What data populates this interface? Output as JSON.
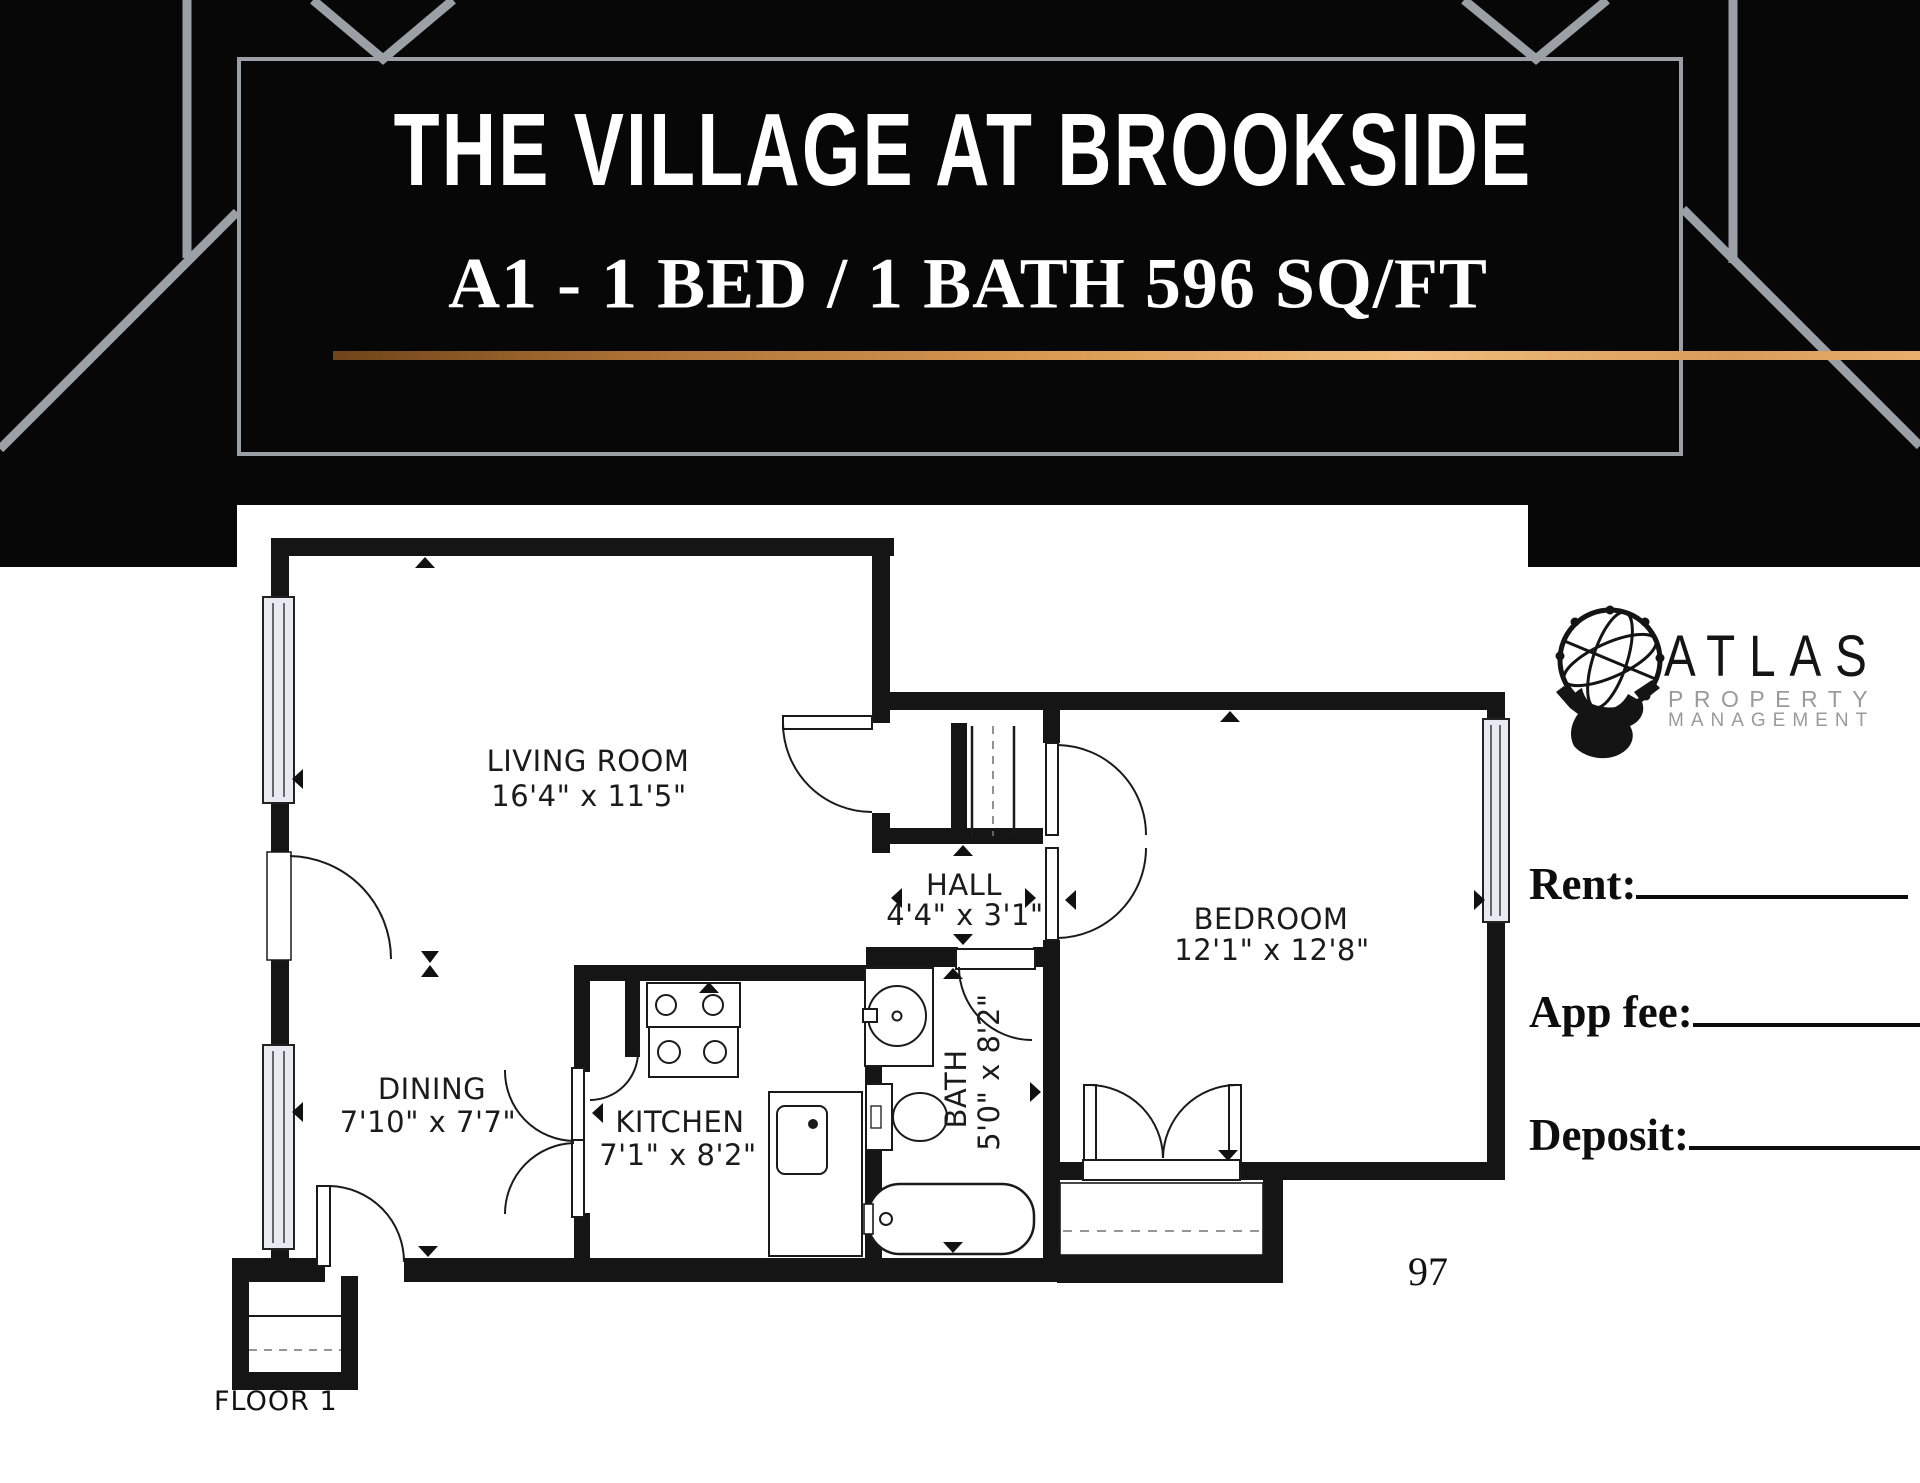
{
  "header": {
    "title": "THE VILLAGE AT BROOKSIDE",
    "subtitle": "A1 - 1 BED / 1 BATH 596 SQ/FT"
  },
  "floor_plan": {
    "rooms": [
      {
        "name": "LIVING ROOM",
        "dims": "16'4\" x 11'5\""
      },
      {
        "name": "DINING",
        "dims": "7'10\" x 7'7\""
      },
      {
        "name": "KITCHEN",
        "dims": "7'1\" x 8'2\""
      },
      {
        "name": "HALL",
        "dims": "4'4\" x 3'1\""
      },
      {
        "name": "BATH",
        "dims": "5'0\" x 8'2\""
      },
      {
        "name": "BEDROOM",
        "dims": "12'1\" x 12'8\""
      }
    ],
    "floor_label": "FLOOR 1",
    "unit_number": "97"
  },
  "logo": {
    "brand": "ATLAS",
    "line1": "PROPERTY",
    "line2": "MANAGEMENT"
  },
  "pricing": {
    "rent_label": "Rent:",
    "app_fee_label": "App fee:",
    "deposit_label": "Deposit:"
  },
  "colors": {
    "banner_black": "#070707",
    "deco_gray": "#9ba0a6",
    "accent_gold": "#d99a52",
    "wall_black": "#151515",
    "window_fill": "#e9e9f2"
  }
}
